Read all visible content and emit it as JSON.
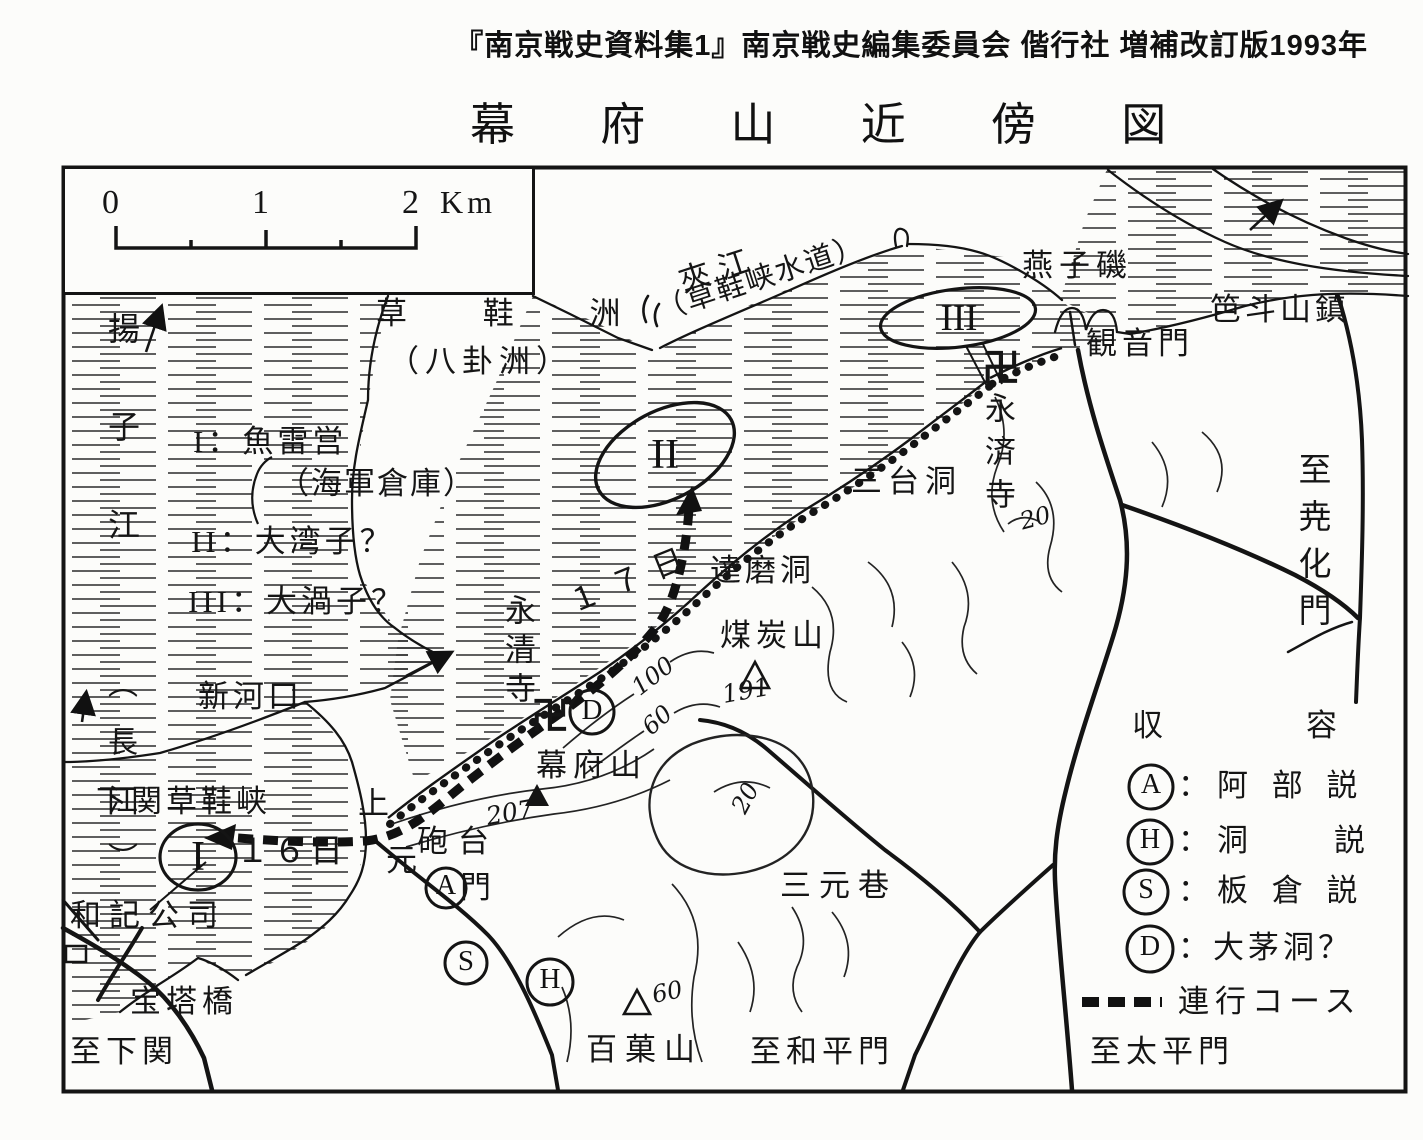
{
  "attribution": "『南京戦史資料集1』南京戦史編集委員会 偕行社 増補改訂版1993年",
  "title": "幕 府 山 近 傍 図",
  "scale_bar": {
    "t0": "0",
    "t1": "1",
    "t2": "2",
    "unit": "Km"
  },
  "site_legend": {
    "line1": "I：魚雷営",
    "line2": "（海軍倉庫）",
    "line3": "II：大湾子？",
    "line4": "III：大渦子？"
  },
  "camp_legend": {
    "title": "収　容　所",
    "a": {
      "sym": "A",
      "label": "：阿 部 説"
    },
    "h": {
      "sym": "H",
      "label": "：洞　　説"
    },
    "s": {
      "sym": "S",
      "label": "：板 倉 説"
    },
    "d": {
      "sym": "D",
      "label": "：大茅洞？"
    },
    "route_label": "連行コース"
  },
  "markers": {
    "site1": "I",
    "site2": "II",
    "site3": "III",
    "a": "A",
    "h": "H",
    "s": "S",
    "d": "D",
    "temple1": "卍",
    "temple2": "卍"
  },
  "dates": {
    "d16": "１６日",
    "d17": "１７日"
  },
  "places": {
    "yangtze": "揚子江",
    "yangtze_alt": "（長江）",
    "caoxiezhou": "草 鞋 洲",
    "baguazhou": "（八卦洲）",
    "jiajiang": "夾江",
    "jiajiang_alt": "（草鞋峡水道）",
    "yanziji": "燕子磯",
    "badoushan": "笆斗山鎮",
    "guanyinmen": "観音門",
    "yongjiji": "永済寺",
    "santaidong": "三台洞",
    "yaohuamen": "至尭化門",
    "damodong": "達磨洞",
    "meitanshan": "煤炭山",
    "yongqingji": "永清寺",
    "mufushan": "幕府山",
    "xinhekou": "新河口",
    "xiaguan": "下関草鞋峡",
    "wajigongsi": "和記公司",
    "shang": "上",
    "yuan": "元",
    "men": "門",
    "paotai": "砲台",
    "sanyuanxiang": "三元巷",
    "baiguoshan": "百菓山",
    "baotaqiao": "宝塔橋",
    "to_xiaguan": "至下関",
    "to_heping": "至和平門",
    "to_taiping": "至太平門"
  },
  "elevations": {
    "mufu": "207",
    "meitan": "191",
    "baiguo": "60"
  },
  "contours": {
    "c100": "100",
    "c60": "60",
    "c20a": "20",
    "c20b": "20"
  }
}
